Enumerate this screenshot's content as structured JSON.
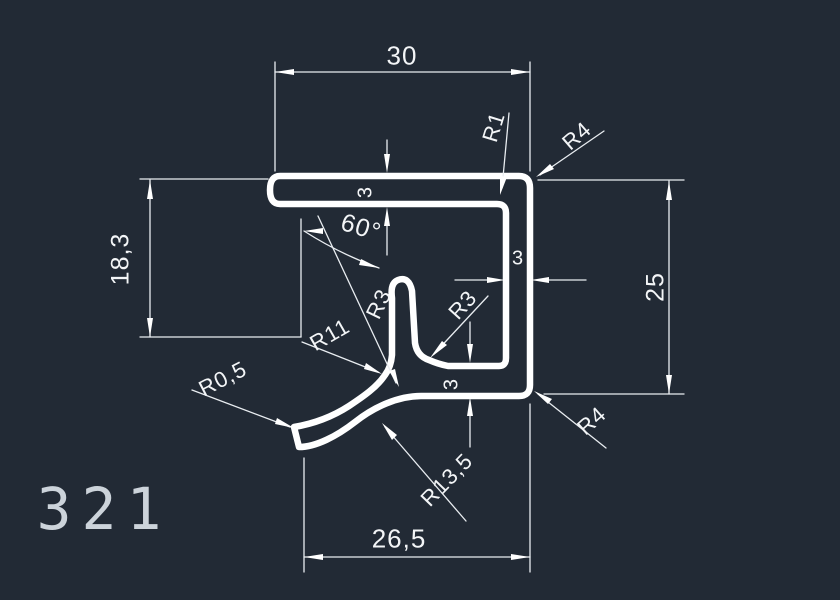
{
  "drawing": {
    "part_number": "321",
    "background_color": "#222a35",
    "geometry_color": "#ffffff",
    "dimension_line_color": "#e9edf1",
    "text_color": "#f3f5f7",
    "part_number_color": "#ccd3da"
  },
  "dims": {
    "top_width": "30",
    "flange_thickness": "3",
    "angle": "60°",
    "left_height": "18,3",
    "radius_inner_top": "R1",
    "radius_outer_top": "R4",
    "wall_thickness": "3",
    "right_height": "25",
    "radius_tongue_left": "R3",
    "radius_tongue_right": "R3",
    "radius_hook_inner": "R11",
    "radius_tip": "R0,5",
    "bottom_thickness": "3",
    "radius_outer_bottom": "R4",
    "radius_hook_outer": "R13,5",
    "bottom_width": "26,5"
  }
}
